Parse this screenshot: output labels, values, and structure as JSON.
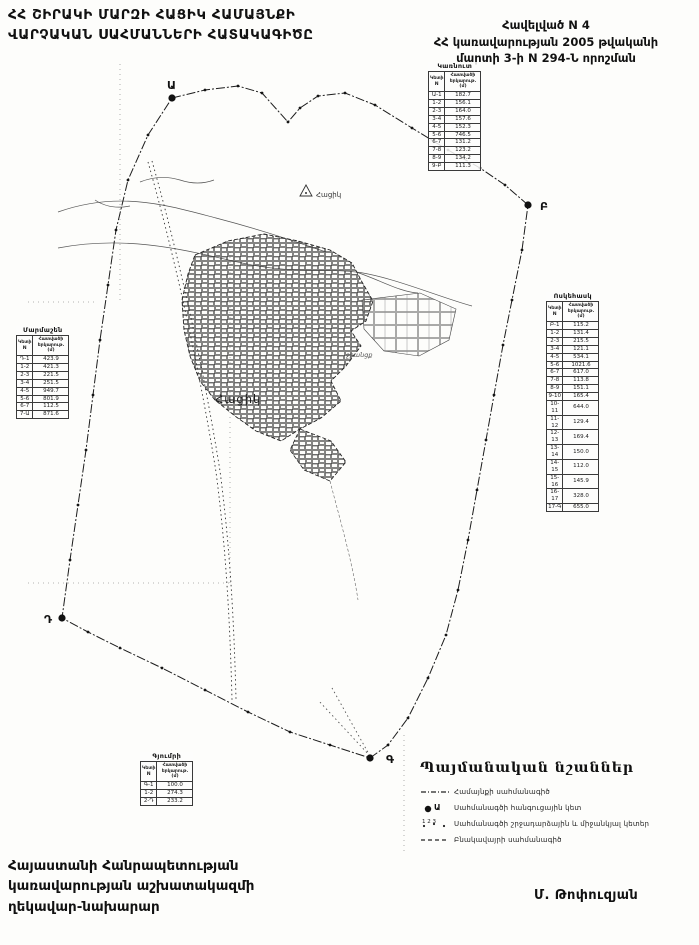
{
  "header": {
    "title": "ՀՀ ՇԻՐԱԿԻ ՄԱՐԶԻ ՀԱՑԻԿ ՀԱՄԱՅՆՔԻ\nՎԱՐՉԱԿԱՆ ՍԱՀՄԱՆՆԵՐԻ ՀԱՏԱԿԱԳԻԾԸ",
    "appendix_line1": "Հավելված N 4",
    "appendix_line2": "ՀՀ կառավարության 2005 թվականի",
    "appendix_line3": "մարտի 3-ի N 294-Ն որոշման"
  },
  "map": {
    "node_points": {
      "a": "Ա",
      "b": "Բ",
      "g": "Գ",
      "d": "Դ"
    },
    "settlement_label": "Հացիկ",
    "geo_point_label": "Հացիկ",
    "canal_label": "ջրանցք"
  },
  "table_headers": {
    "col1": "Կետի N",
    "col2": "Հատվածի երկարութ. (մ)"
  },
  "tables": {
    "north": {
      "title": "Կառնուտ",
      "rows": [
        [
          "Ա-1",
          "182.7"
        ],
        [
          "1-2",
          "156.1"
        ],
        [
          "2-3",
          "164.0"
        ],
        [
          "3-4",
          "157.6"
        ],
        [
          "4-5",
          "152.3"
        ],
        [
          "5-6",
          "746.5"
        ],
        [
          "6-7",
          "131.2"
        ],
        [
          "7-8",
          "123.2"
        ],
        [
          "8-9",
          "134.2"
        ],
        [
          "9-Բ",
          "111.3"
        ]
      ]
    },
    "west": {
      "title": "Մարմաշեն",
      "rows": [
        [
          "Դ-1",
          "423.9"
        ],
        [
          "1-2",
          "421.3"
        ],
        [
          "2-3",
          "221.5"
        ],
        [
          "3-4",
          "251.5"
        ],
        [
          "4-5",
          "949.7"
        ],
        [
          "5-6",
          "801.9"
        ],
        [
          "6-7",
          "112.5"
        ],
        [
          "7-Ա",
          "871.6"
        ]
      ]
    },
    "east": {
      "title": "Ոսկեհասկ",
      "rows": [
        [
          "Բ-1",
          "115.2"
        ],
        [
          "1-2",
          "131.4"
        ],
        [
          "2-3",
          "215.5"
        ],
        [
          "3-4",
          "121.1"
        ],
        [
          "4-5",
          "534.1"
        ],
        [
          "5-6",
          "1021.6"
        ],
        [
          "6-7",
          "617.0"
        ],
        [
          "7-8",
          "113.8"
        ],
        [
          "8-9",
          "151.1"
        ],
        [
          "9-10",
          "165.4"
        ],
        [
          "10-11",
          "644.0"
        ],
        [
          "11-12",
          "129.4"
        ],
        [
          "12-13",
          "169.4"
        ],
        [
          "13-14",
          "150.0"
        ],
        [
          "14-15",
          "112.0"
        ],
        [
          "15-16",
          "145.9"
        ],
        [
          "16-17",
          "328.0"
        ],
        [
          "17-Գ",
          "655.0"
        ]
      ]
    },
    "south": {
      "title": "Գյումրի",
      "rows": [
        [
          "Գ-1",
          "100.0"
        ],
        [
          "1-2",
          "274.3"
        ],
        [
          "2-Դ",
          "233.2"
        ]
      ]
    }
  },
  "legend": {
    "title": "Պայմանական նշաններ",
    "items": [
      {
        "label": "Համայնքի սահմանագիծ"
      },
      {
        "label": "Սահմանագծի հանգուցային կետ",
        "symbol": "Ա"
      },
      {
        "label": "Սահմանագծի շրջադարձային և միջանկյալ կետեր",
        "symbol": "1 2 3"
      },
      {
        "label": "Բնակավայրի սահմանագիծ"
      }
    ]
  },
  "footer": {
    "text": "Հայաստանի Հանրապետության\nկառավարության աշխատակազմի\nղեկավար-նախարար",
    "signature": "Մ. Թոփուզյան"
  }
}
